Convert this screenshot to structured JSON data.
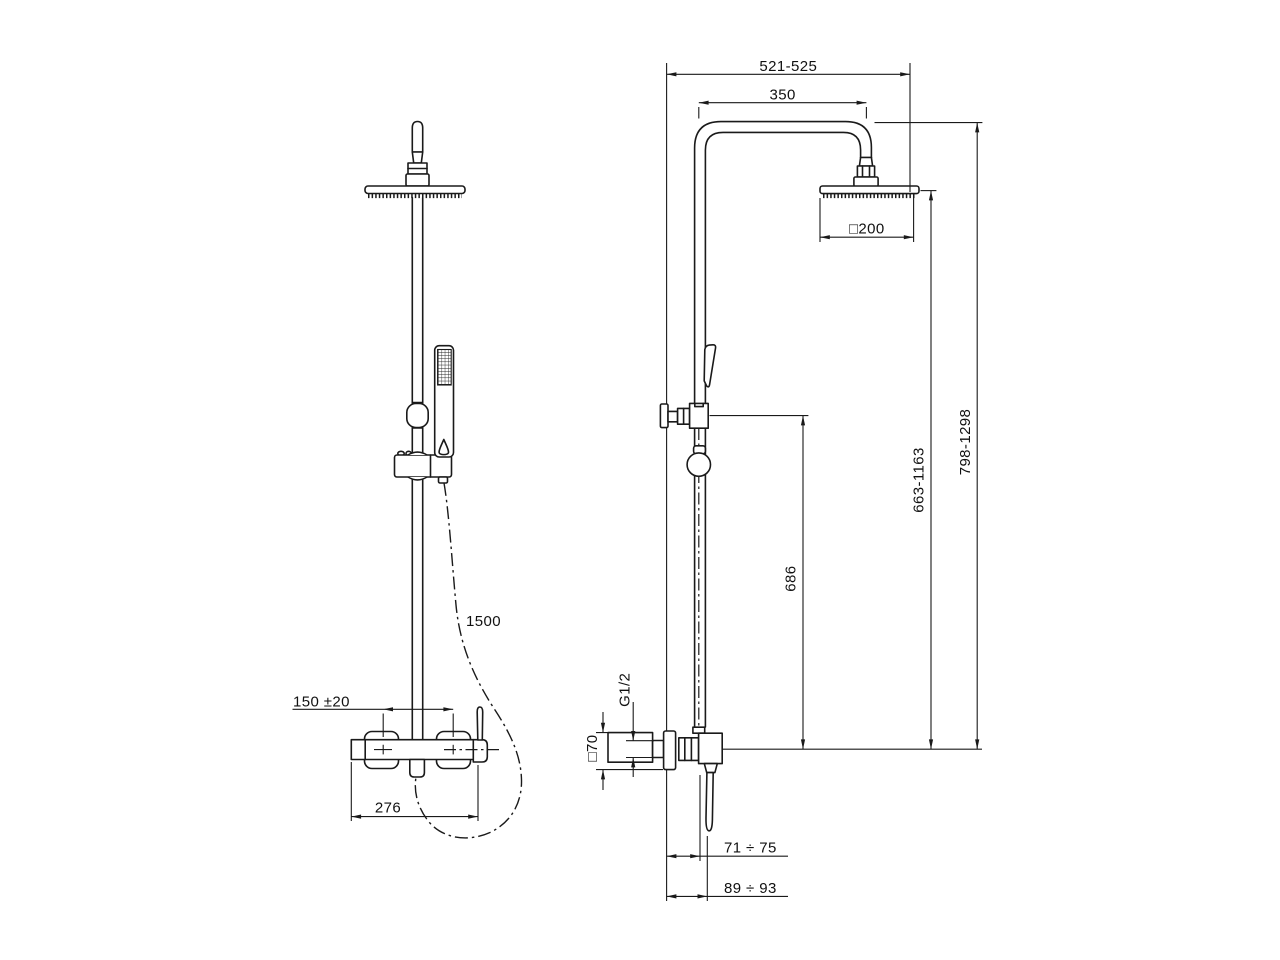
{
  "drawing": {
    "title_hint": "shower column dimensional drawing",
    "line_color": "#1a1a1a",
    "background": "#ffffff",
    "left_view": {
      "hose_length": "1500",
      "inlet_spacing": "150 ±20",
      "body_width": "276"
    },
    "right_view": {
      "overall_width": "521-525",
      "arm_projection": "350",
      "head_size": "□200",
      "overall_height": "798-1298",
      "head_height": "663-1163",
      "diverter_height": "686",
      "thread": "G1/2",
      "escutcheon_size": "□70",
      "wall_to_handle": "71 ÷ 75",
      "wall_to_handle_tip": "89 ÷ 93"
    }
  }
}
